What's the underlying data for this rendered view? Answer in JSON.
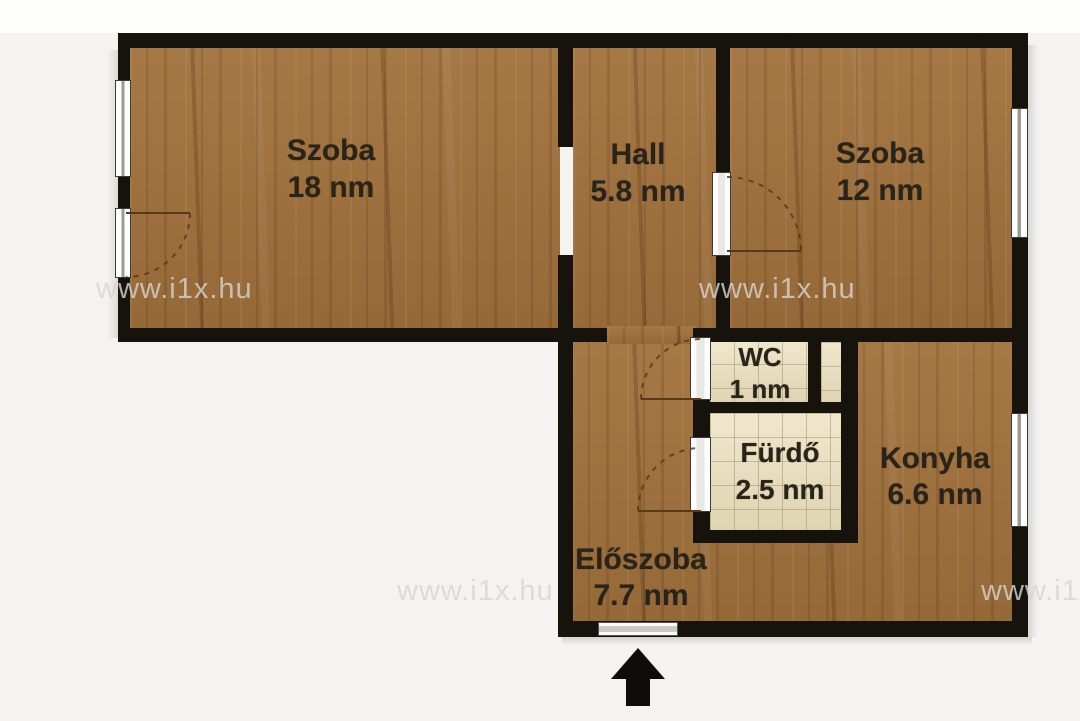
{
  "plan": {
    "type": "apartment-floor-plan",
    "rooms": [
      {
        "id": "szoba-18",
        "name": "Szoba",
        "area": "18 nm"
      },
      {
        "id": "hall",
        "name": "Hall",
        "area": "5.8 nm"
      },
      {
        "id": "szoba-12",
        "name": "Szoba",
        "area": "12 nm"
      },
      {
        "id": "wc",
        "name": "WC",
        "area": "1 nm"
      },
      {
        "id": "furdo",
        "name": "Fürdő",
        "area": "2.5 nm"
      },
      {
        "id": "konyha",
        "name": "Konyha",
        "area": "6.6 nm"
      },
      {
        "id": "eloszoba",
        "name": "Előszoba",
        "area": "7.7 nm"
      }
    ],
    "watermark": {
      "text": "www.i1x.hu"
    },
    "entrance": {
      "indicator": "up-arrow"
    },
    "colors": {
      "wall": "#16130d",
      "wood_floor": "#a1713c",
      "tile_floor": "#ebdfbc",
      "background": "#f4f3f1",
      "label_text": "#28241a",
      "watermark": "#d8d5d0",
      "door_swing": "#5a3917"
    }
  }
}
